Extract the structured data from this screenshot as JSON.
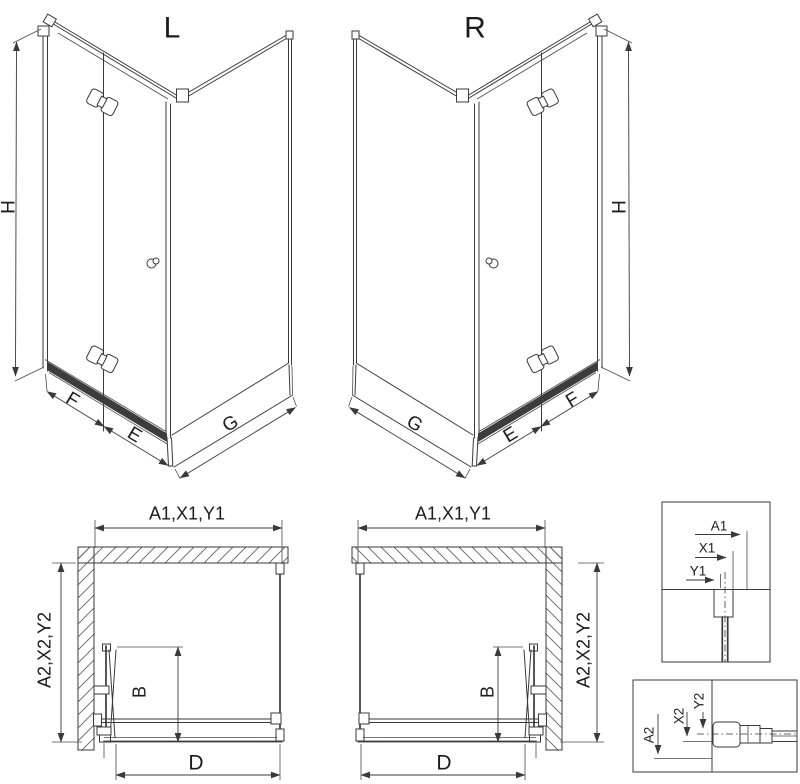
{
  "title_labels": {
    "left_view": "L",
    "right_view": "R"
  },
  "dimension_labels": {
    "height": "H",
    "front_panel": "F",
    "front_door": "E",
    "side_panel": "G",
    "plan_top": "A1,X1,Y1",
    "plan_side": "A2,X2,Y2",
    "door_depth": "B",
    "front_width": "D",
    "detail_top": [
      "A1",
      "X1",
      "Y1"
    ],
    "detail_bottom": [
      "A2",
      "X2",
      "Y2"
    ]
  },
  "colors": {
    "line": "#3a3a3a",
    "dark_rail": "#2d2d2d",
    "background": "#ffffff",
    "text": "#1c1c1c"
  }
}
